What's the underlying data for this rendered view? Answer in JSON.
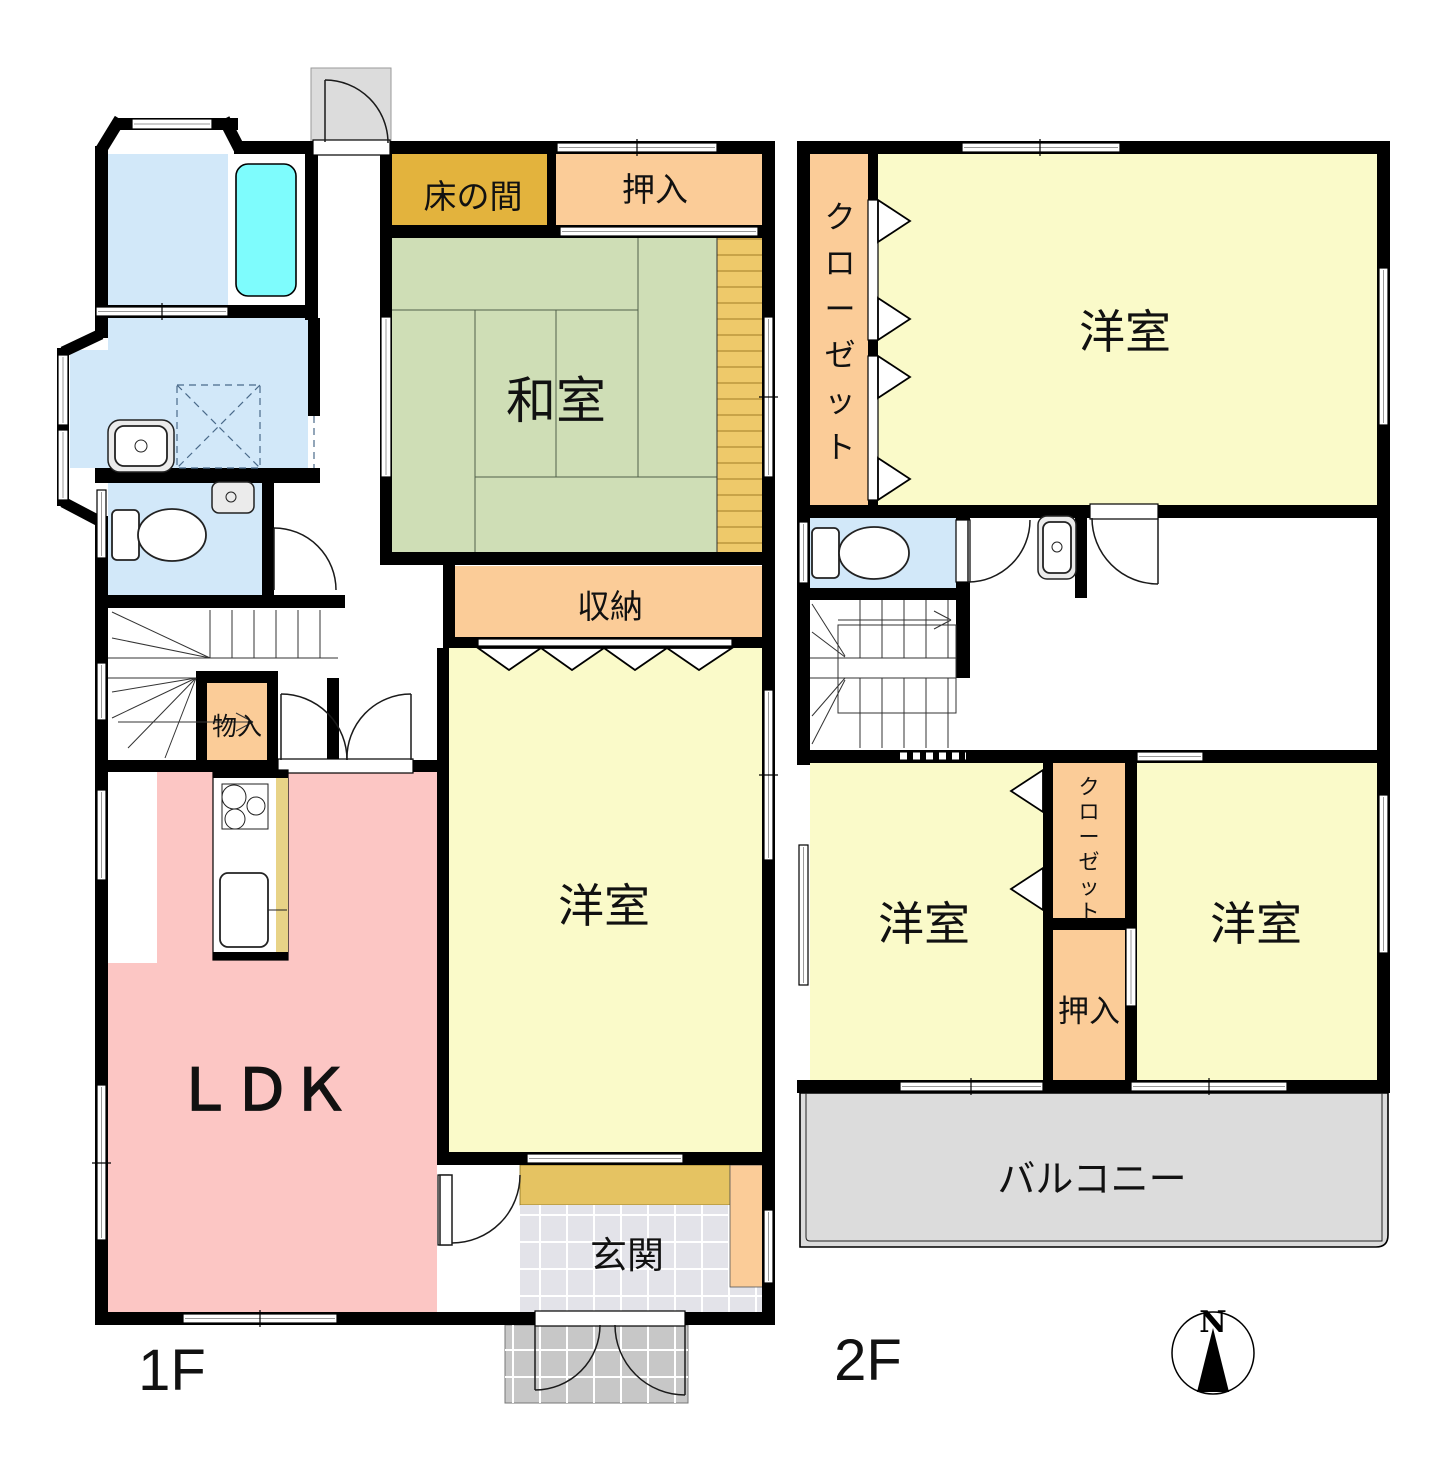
{
  "floor1": {
    "floor_label": "1F",
    "rooms": {
      "tokonoma": "床の間",
      "oshiire": "押入",
      "washitsu": "和室",
      "shunou": "収納",
      "monoire": "物入",
      "youshitsu": "洋室",
      "ldk": "ＬＤＫ",
      "genkan": "玄関"
    }
  },
  "floor2": {
    "floor_label": "2F",
    "rooms": {
      "closet_main": "クローゼット",
      "youshitsu_main": "洋室",
      "youshitsu_left": "洋室",
      "youshitsu_right": "洋室",
      "closet_small": "クローゼット",
      "oshiire": "押入",
      "balcony": "バルコニー"
    }
  },
  "compass": {
    "north": "N"
  },
  "colors": {
    "wall": "#000000",
    "tatami": "#cfdeb6",
    "tokonoma": "#e3b33d",
    "closet": "#fbcc98",
    "western_room": "#fafac9",
    "ldk": "#fcc6c4",
    "water": "#d2e8f9",
    "bathtub": "#7efcfd",
    "balcony": "#dcdcdc",
    "genkan_tile": "#e3e3e9",
    "porch": "#c7c7c7",
    "step": "#e5c362",
    "engawa": "#eec96a",
    "counter": "#e8d387"
  }
}
